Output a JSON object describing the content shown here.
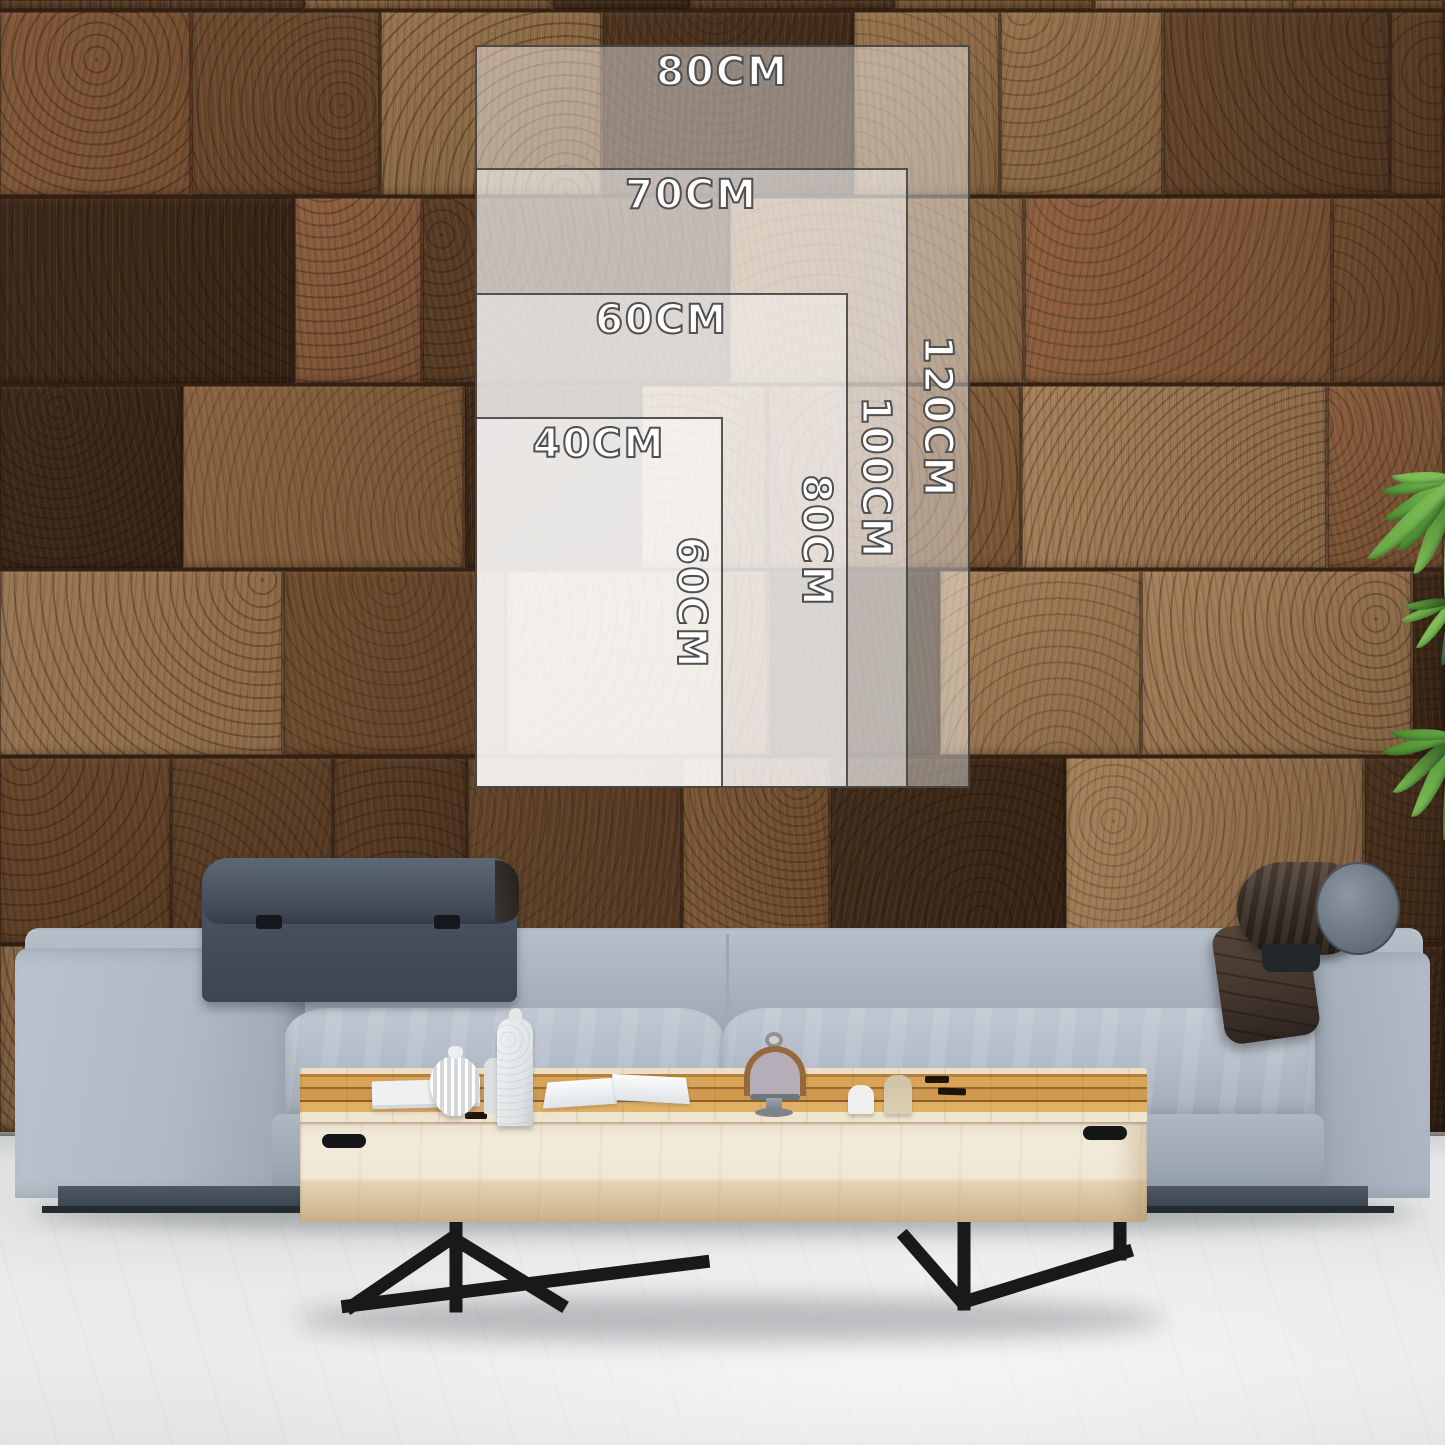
{
  "scene": {
    "description": "Living room wall-art size guide mockup",
    "wall": {
      "material": "end-grain wood blocks",
      "base_color": "#6f4d2f"
    },
    "floor": {
      "color": "#eceeef"
    },
    "sofa": {
      "fabric_color": "#aab4c0",
      "headrest_color": "#4e5967",
      "bolster_color": "#3a2f27",
      "base_color": "#44505b"
    },
    "coffee_table": {
      "top_color": "#cf9a4e",
      "front_color": "#f1ead9",
      "legs_color": "#17191b"
    },
    "plant": {
      "color": "#49892f"
    }
  },
  "size_guide": {
    "unit": "CM",
    "overlay_fill": "#ffffff",
    "overlay_border": "#3c3c3c",
    "label_color": "#ffffff",
    "label_outline": "#4f4f4f",
    "sizes": [
      {
        "width_label": "80CM",
        "height_label": "120CM"
      },
      {
        "width_label": "70CM",
        "height_label": "100CM"
      },
      {
        "width_label": "60CM",
        "height_label": "80CM"
      },
      {
        "width_label": "40CM",
        "height_label": "60CM"
      }
    ]
  }
}
